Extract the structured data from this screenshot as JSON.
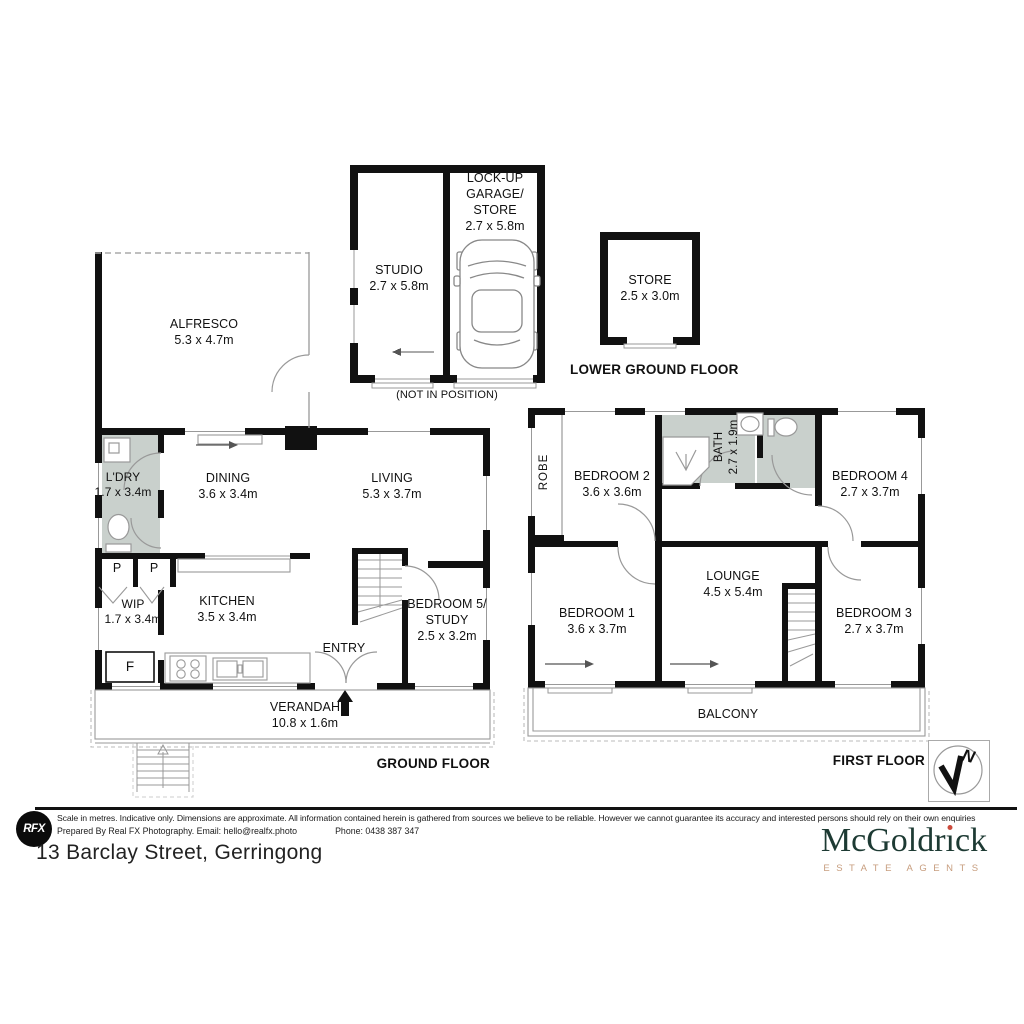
{
  "address": "13 Barclay Street, Gerringong",
  "branding": {
    "agency_name": "McGoldrick",
    "agency_name_parts": {
      "pre": "McGoldr",
      "i_dotless": "ı",
      "post": "ck"
    },
    "agency_tagline": "ESTATE AGENTS",
    "photographer_logo": "RFX"
  },
  "disclaimer": {
    "line1": "Scale in metres. Indicative only. Dimensions are approximate. All information contained herein is gathered from sources we believe to be reliable. However we cannot guarantee its accuracy and interested persons should rely on their own enquiries",
    "prepared": "Prepared By Real FX Photography. Email: hello@realfx.photo",
    "phone": "Phone: 0438 387 347"
  },
  "floor_labels": {
    "lower_ground": "LOWER GROUND FLOOR",
    "ground": "GROUND FLOOR",
    "first": "FIRST FLOOR"
  },
  "annotations": {
    "not_in_position": "(NOT IN POSITION)",
    "entry": "ENTRY",
    "north": "N",
    "pantry_left": "P",
    "pantry_right": "P",
    "fridge": "F"
  },
  "rooms": {
    "studio": {
      "name": "STUDIO",
      "dims": "2.7 x 5.8m"
    },
    "garage": {
      "name": "LOCK-UP GARAGE/ STORE",
      "dims": "2.7 x 5.8m"
    },
    "store": {
      "name": "STORE",
      "dims": "2.5 x 3.0m"
    },
    "alfresco": {
      "name": "ALFRESCO",
      "dims": "5.3 x 4.7m"
    },
    "laundry": {
      "name": "L'DRY",
      "dims": "1.7 x 3.4m"
    },
    "dining": {
      "name": "DINING",
      "dims": "3.6 x 3.4m"
    },
    "living": {
      "name": "LIVING",
      "dims": "5.3 x 3.7m"
    },
    "wip": {
      "name": "WIP",
      "dims": "1.7 x 3.4m"
    },
    "kitchen": {
      "name": "KITCHEN",
      "dims": "3.5 x 3.4m"
    },
    "bedroom5": {
      "name": "BEDROOM 5/ STUDY",
      "dims": "2.5 x 3.2m"
    },
    "verandah": {
      "name": "VERANDAH",
      "dims": "10.8 x 1.6m"
    },
    "robe": {
      "name": "ROBE"
    },
    "bedroom2": {
      "name": "BEDROOM 2",
      "dims": "3.6 x 3.6m"
    },
    "bath": {
      "name": "BATH",
      "dims": "2.7 x 1.9m"
    },
    "bedroom4": {
      "name": "BEDROOM 4",
      "dims": "2.7 x 3.7m"
    },
    "bedroom1": {
      "name": "BEDROOM 1",
      "dims": "3.6 x 3.7m"
    },
    "lounge": {
      "name": "LOUNGE",
      "dims": "4.5 x 5.4m"
    },
    "bedroom3": {
      "name": "BEDROOM 3",
      "dims": "2.7 x 3.7m"
    },
    "balcony": {
      "name": "BALCONY"
    }
  },
  "colors": {
    "wall": "#111111",
    "wet_area": "#c9d0cc",
    "thin_line": "#999999",
    "brand_green": "#1d3a33",
    "brand_tan": "#c79d7e",
    "brand_dot": "#cc4b3c"
  },
  "icons": {
    "car": "car-top-view",
    "compass": "north-arrow",
    "toilet": "toilet",
    "shower": "shower",
    "basin": "basin",
    "cooktop": "cooktop",
    "sink": "double-sink",
    "stairs": "stairs"
  }
}
